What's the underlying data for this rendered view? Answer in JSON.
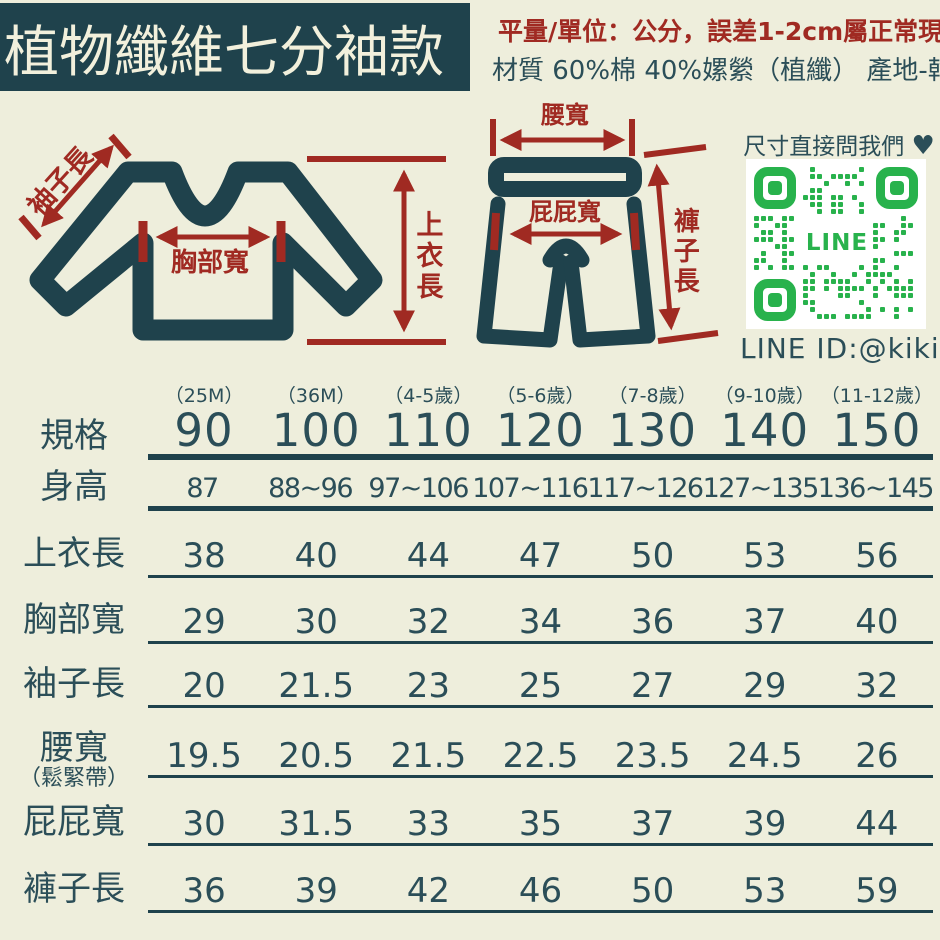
{
  "banner": {
    "title": "植物纖維七分袖款"
  },
  "notes": {
    "measure": "平量/單位：公分，誤差1-2cm屬正常現象",
    "material": "材質 60%棉 40%嫘縈（植纖） 產地-韓國"
  },
  "colors": {
    "background": "#eeeedc",
    "teal": "#1f424c",
    "red": "#a02a22",
    "line_green": "#28b24c"
  },
  "diagrams": {
    "shirt": {
      "sleeve_label": "袖子長",
      "chest_label": "胸部寬",
      "length_label": "上衣長"
    },
    "pants": {
      "waist_label": "腰寬",
      "hip_label": "屁屁寬",
      "length_label": "褲子長"
    }
  },
  "contact": {
    "ask_text": "尺寸直接問我們",
    "heart_icon": "♥",
    "qr_center_text": "LINE",
    "line_id": "LINE ID:@kikis",
    "green": "#28b24c"
  },
  "size_table": {
    "row_header_label": "規格",
    "columns": [
      {
        "age": "（25M）",
        "size": "90"
      },
      {
        "age": "（36M）",
        "size": "100"
      },
      {
        "age": "（4-5歲）",
        "size": "110"
      },
      {
        "age": "（5-6歲）",
        "size": "120"
      },
      {
        "age": "（7-8歲）",
        "size": "130"
      },
      {
        "age": "（9-10歲）",
        "size": "140"
      },
      {
        "age": "（11-12歲）",
        "size": "150"
      }
    ],
    "waist_note": "（鬆緊帶）",
    "rows": [
      {
        "label": "身高",
        "values": [
          "87",
          "88~96",
          "97~106",
          "107~116",
          "117~126",
          "127~135",
          "136~145"
        ]
      },
      {
        "label": "上衣長",
        "values": [
          "38",
          "40",
          "44",
          "47",
          "50",
          "53",
          "56"
        ]
      },
      {
        "label": "胸部寬",
        "values": [
          "29",
          "30",
          "32",
          "34",
          "36",
          "37",
          "40"
        ]
      },
      {
        "label": "袖子長",
        "values": [
          "20",
          "21.5",
          "23",
          "25",
          "27",
          "29",
          "32"
        ]
      },
      {
        "label": "腰寬",
        "values": [
          "19.5",
          "20.5",
          "21.5",
          "22.5",
          "23.5",
          "24.5",
          "26"
        ]
      },
      {
        "label": "屁屁寬",
        "values": [
          "30",
          "31.5",
          "33",
          "35",
          "37",
          "39",
          "44"
        ]
      },
      {
        "label": "褲子長",
        "values": [
          "36",
          "39",
          "42",
          "46",
          "50",
          "53",
          "59"
        ]
      }
    ]
  }
}
